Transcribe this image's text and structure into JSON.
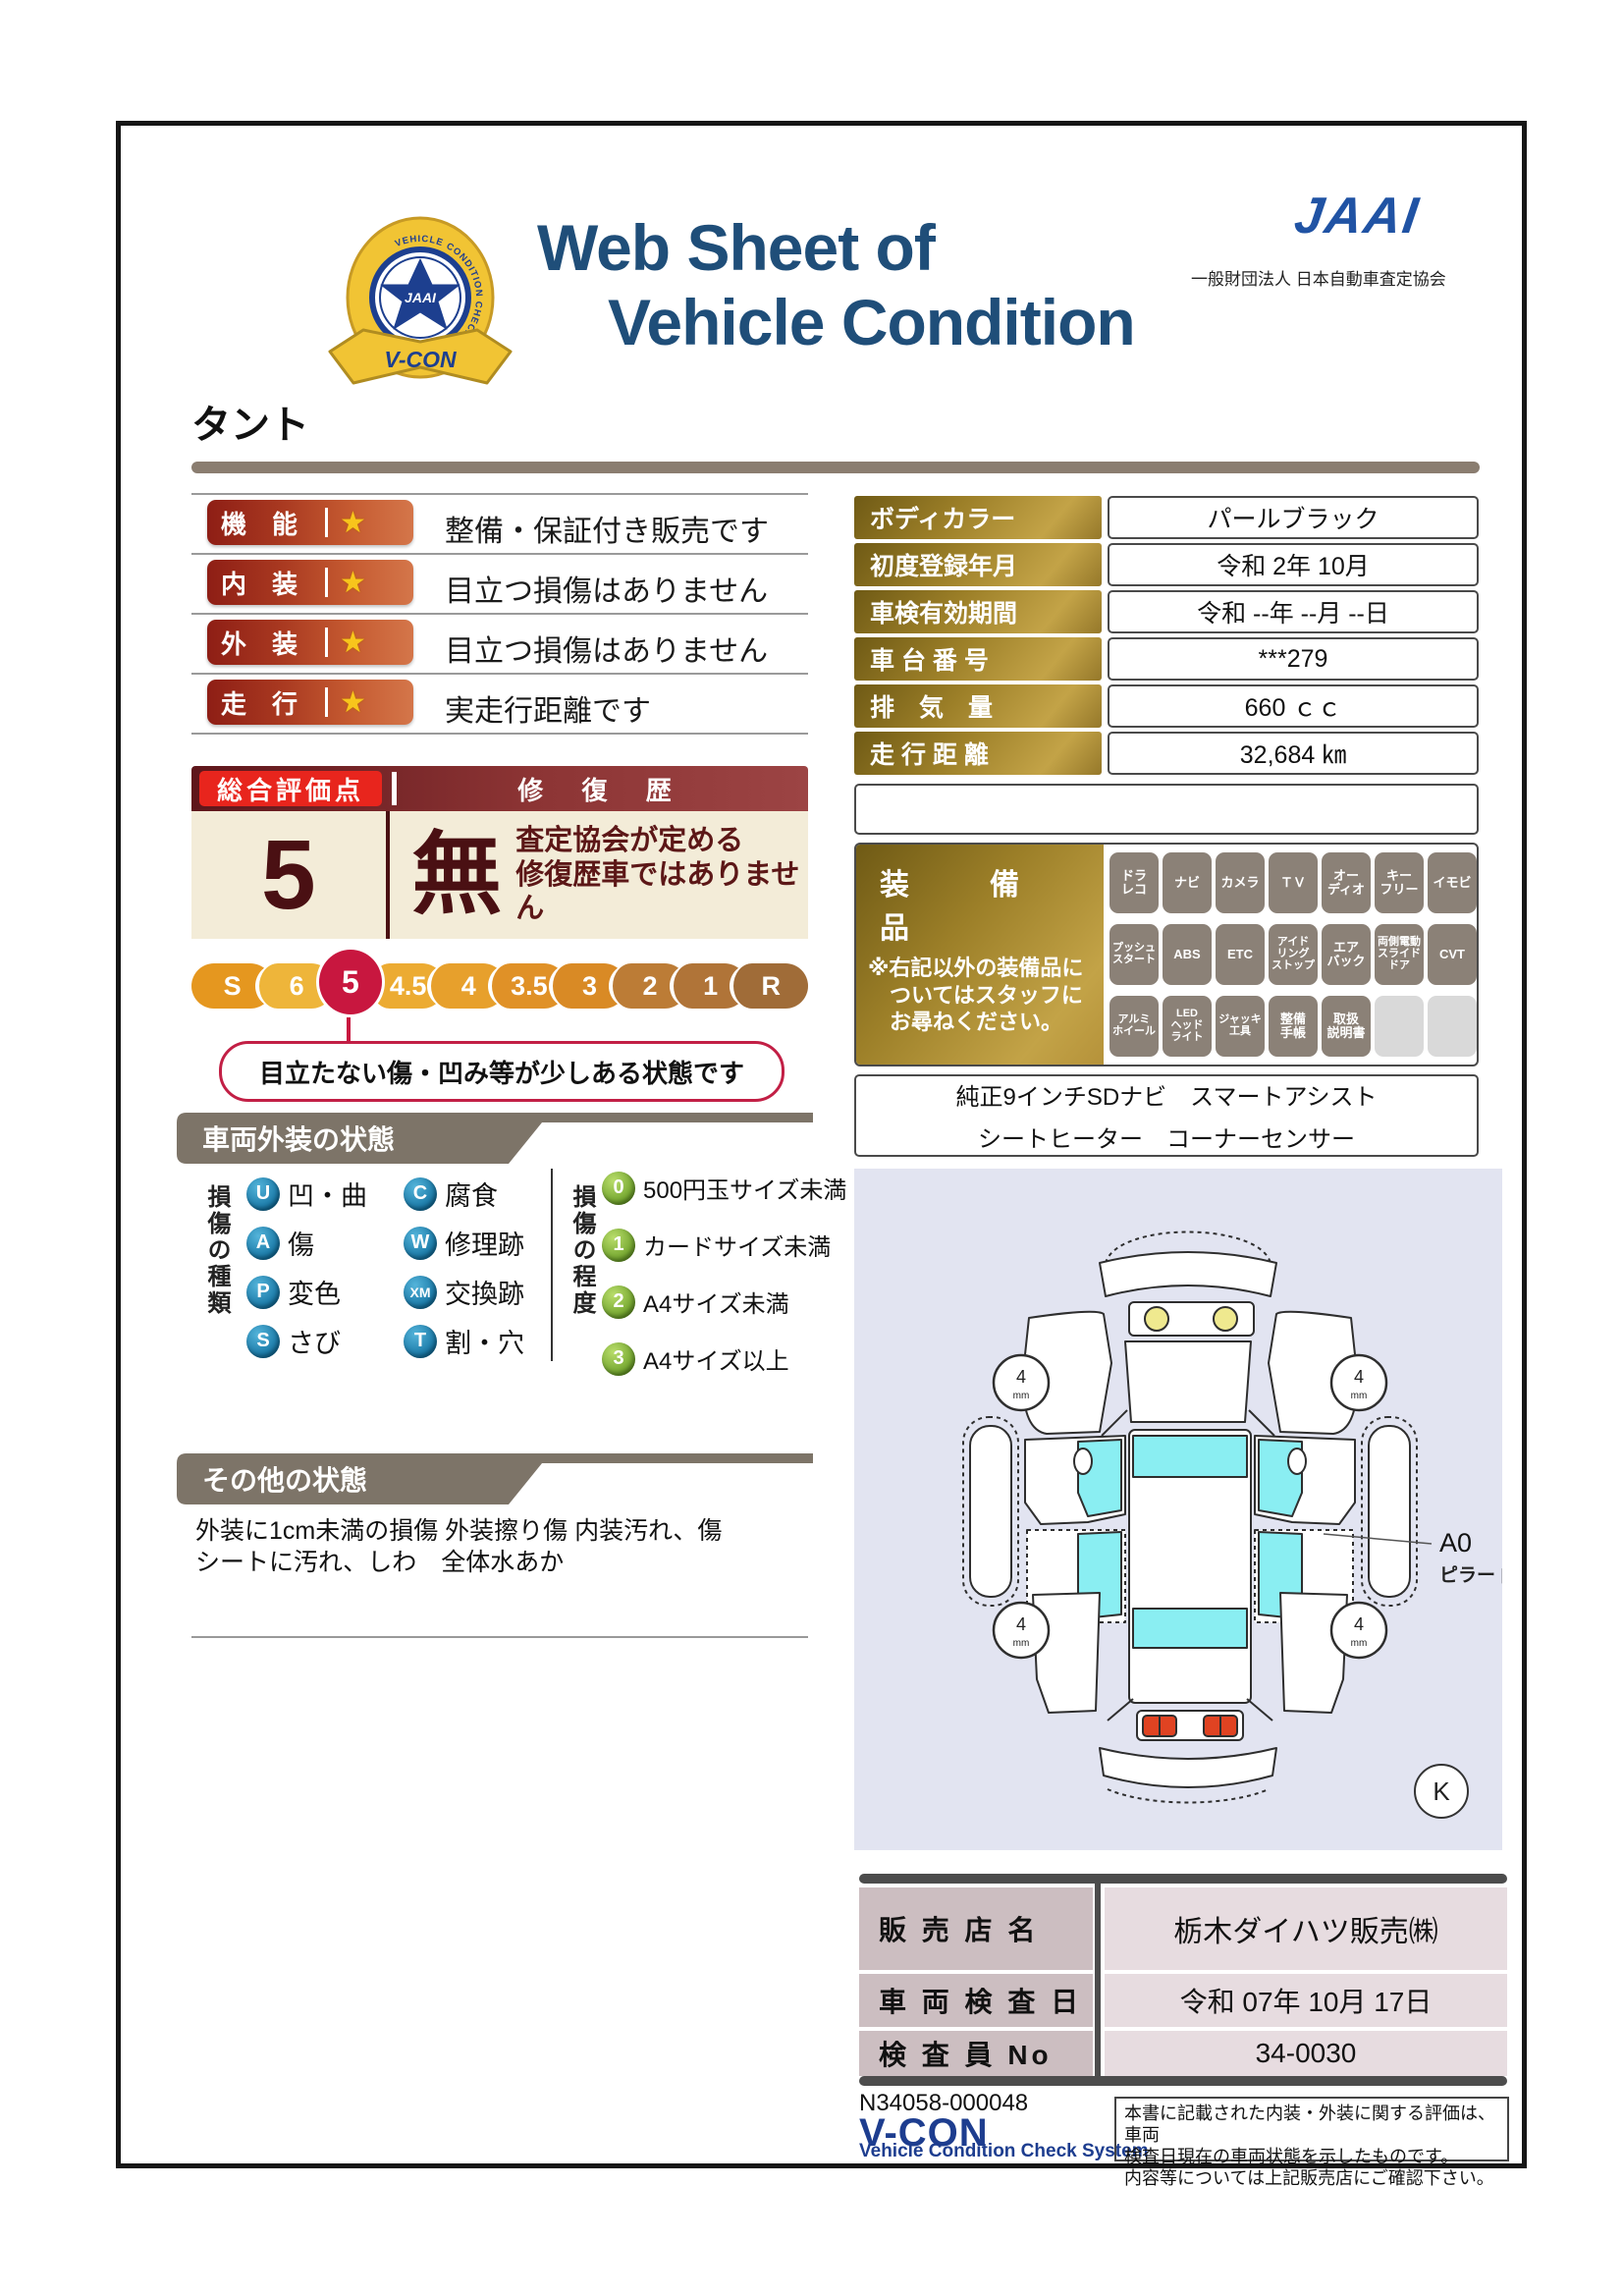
{
  "header": {
    "title_line1": "Web Sheet of",
    "title_line2": "Vehicle Condition",
    "jaai_logo": "JAAI",
    "jaai_subtitle": "一般財団法人 日本自動車査定協会",
    "emblem": {
      "ring_text": "VEHICLE CONDITION CHECK SYSTEM",
      "star_text": "JAAI",
      "ribbon_text": "V-CON"
    }
  },
  "vehicle_name": "タント",
  "ratings": [
    {
      "label": "機　能",
      "star": "★",
      "description": "整備・保証付き販売です"
    },
    {
      "label": "内　装",
      "star": "★",
      "description": "目立つ損傷はありません"
    },
    {
      "label": "外　装",
      "star": "★",
      "description": "目立つ損傷はありません"
    },
    {
      "label": "走　行",
      "star": "★",
      "description": "実走行距離です"
    }
  ],
  "overall": {
    "header_left": "総合評価点",
    "header_right": "修 復 歴",
    "score": "5",
    "repair_mark": "無",
    "repair_note_line1": "査定協会が定める",
    "repair_note_line2": "修復歴車ではありません",
    "scale": [
      "S",
      "6",
      "5",
      "4.5",
      "4",
      "3.5",
      "3",
      "2",
      "1",
      "R"
    ],
    "selected": "5",
    "callout": "目立たない傷・凹み等が少しある状態です"
  },
  "info_table": {
    "rows": [
      {
        "label": "ボディカラー",
        "value": "パールブラック"
      },
      {
        "label": "初度登録年月",
        "value": "令和 2年 10月"
      },
      {
        "label": "車検有効期間",
        "value": "令和 --年 --月 --日"
      },
      {
        "label": "車 台 番 号",
        "value": "***279"
      },
      {
        "label": "排　気　量",
        "value": "660 ｃｃ"
      },
      {
        "label": "走 行 距 離",
        "value": "32,684 ㎞"
      }
    ]
  },
  "equipment": {
    "title": "装　備　品",
    "note": "※右記以外の装備品に\n　ついてはスタッフに\n　お尋ねください。",
    "badges": [
      "ドラ\nレコ",
      "ナビ",
      "カメラ",
      "ＴＶ",
      "オー\nディオ",
      "キー\nフリー",
      "イモビ",
      "プッシュ\nスタート",
      "ABS",
      "ETC",
      "アイド\nリング\nストップ",
      "エア\nバック",
      "両側電動\nスライド\nドア",
      "CVT",
      "アルミ\nホイール",
      "LED\nヘッド\nライト",
      "ジャッキ\n工具",
      "整備\n手帳",
      "取扱\n説明書",
      "",
      ""
    ],
    "notes_line1": "純正9インチSDナビ　スマートアシスト",
    "notes_line2": "シートヒーター　コーナーセンサー"
  },
  "exterior_section": {
    "banner": "車両外装の状態",
    "type_label": "損傷の種類",
    "types": [
      {
        "code": "U",
        "label": "凹・曲"
      },
      {
        "code": "C",
        "label": "腐食"
      },
      {
        "code": "A",
        "label": "傷"
      },
      {
        "code": "W",
        "label": "修理跡"
      },
      {
        "code": "P",
        "label": "変色"
      },
      {
        "code": "XM",
        "label": "交換跡"
      },
      {
        "code": "S",
        "label": "さび"
      },
      {
        "code": "T",
        "label": "割・穴"
      }
    ],
    "degree_label": "損傷の程度",
    "degrees": [
      {
        "code": "0",
        "label": "500円玉サイズ未満"
      },
      {
        "code": "1",
        "label": "カードサイズ未満"
      },
      {
        "code": "2",
        "label": "A4サイズ未満"
      },
      {
        "code": "3",
        "label": "A4サイズ以上"
      }
    ]
  },
  "other_section": {
    "banner": "その他の状態",
    "line1": "外装に1cm未満の損傷 外装擦り傷 内装汚れ、傷",
    "line2": "シートに汚れ、しわ　全体水あか"
  },
  "diagram": {
    "wheel_value": "4",
    "wheel_unit": "mm",
    "annotation_code": "A0",
    "annotation_label": "ピラー 内側",
    "mark": "K"
  },
  "dealer_table": {
    "rows": [
      {
        "label": "販 売 店 名",
        "value": "栃木ダイハツ販売㈱"
      },
      {
        "label": "車 両 検 査 日",
        "value": "令和 07年 10月 17日"
      },
      {
        "label": "検 査 員 No",
        "value": "34-0030"
      }
    ]
  },
  "footer": {
    "doc_number": "N34058-000048",
    "vcon_logo": "V-CON",
    "vcon_sub": "Vehicle Condition Check System",
    "disclaimer_line1": "本書に記載された内装・外装に関する評価は、車両",
    "disclaimer_line2": "検査日現在の車両状態を示したものです。",
    "disclaimer_line3": "内容等については上記販売店にご確認下さい。"
  },
  "colors": {
    "title_navy": "#1f4e79",
    "jaai_blue": "#2053a4",
    "rating_pill_left": "#8e1e15",
    "rating_pill_right": "#d4764a",
    "score_maroon": "#4a1013",
    "selected_crimson": "#c8173f",
    "bright_red": "#e8251d",
    "cream": "#f3ecd8",
    "banner_gray": "#7d7468",
    "gold": "#9c7f28",
    "legend_blue": "#1271a0",
    "legend_green": "#679c24",
    "glass_cyan": "#8aeef2",
    "diagram_bg": "#e2e4f1"
  }
}
